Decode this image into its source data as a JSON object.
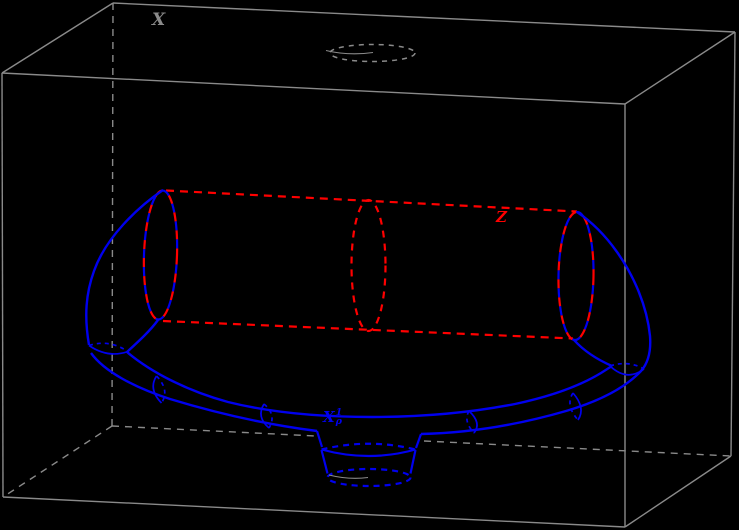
{
  "figure": {
    "type": "3d-topology-diagram",
    "description": "Wireframe box X containing a flattened half-torus tube with meridian rings, a dashed straight cylinder Z joining the two tube end caps, a small cylindrical foot at front-bottom, and a dashed elliptical hole in the top face of the box",
    "labels": {
      "ambient_space": "X",
      "cylinder": "Z",
      "tube": {
        "base": "X",
        "sup": "1",
        "sub": "ρ"
      }
    },
    "colors": {
      "background": "#000000",
      "box": "#8a8a8a",
      "tube": "#0000ee",
      "cylinder": "#ff0000"
    }
  }
}
